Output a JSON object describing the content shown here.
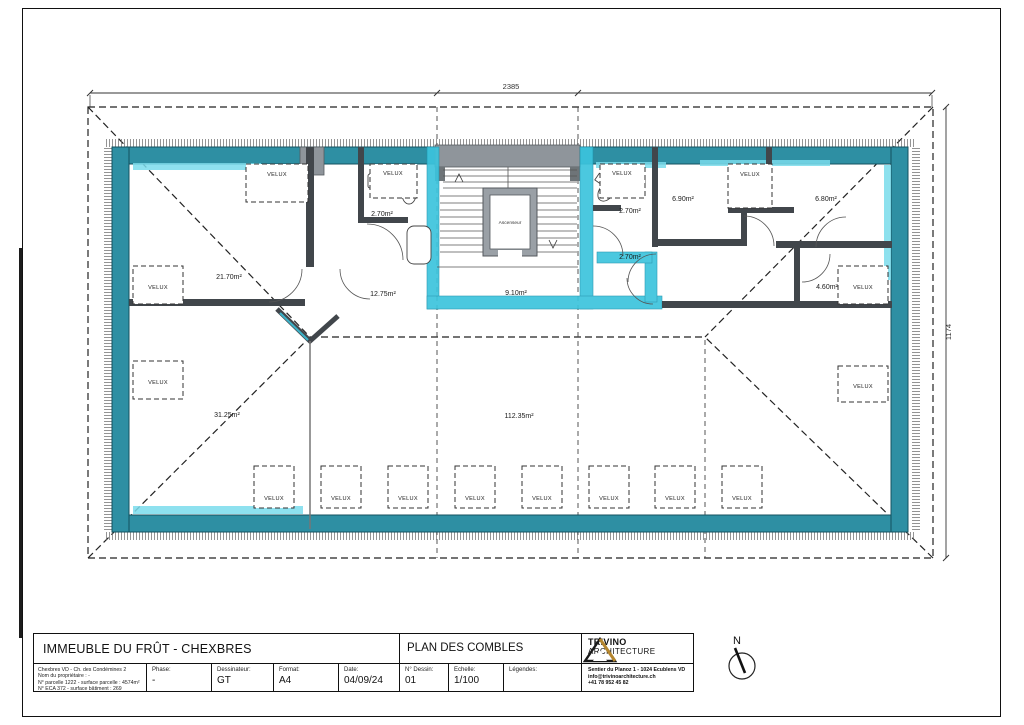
{
  "plan": {
    "velux_label": "VELUX",
    "elevator_label": "Ascenseur",
    "dim_top": "2385",
    "dim_right": "1174",
    "north_label": "N",
    "rooms": {
      "left_bedroom": "21.70m²",
      "left_bath": "2.70m²",
      "left_hall": "12.75m²",
      "corridor": "9.10m²",
      "right_bath": "2.70m²",
      "right_hall": "2.70m²",
      "right_room_a": "6.90m²",
      "right_room_b": "6.80m²",
      "right_room_c": "4.60m²",
      "lower_left_room": "31.25m²",
      "main_room": "112.35m²"
    },
    "colors": {
      "wall_teal": "#2e8fa3",
      "wall_cyan": "#3cc4dd",
      "stair_gray": "#8f959b"
    }
  },
  "titleblock": {
    "project_title": "IMMEUBLE DU FRÛT - CHEXBRES",
    "drawing_title": "PLAN DES COMBLES",
    "info_line_1": "Chexbres VD - Ch. des Condémines 2",
    "info_line_2": "Nom du propriétaire : -",
    "info_line_3": "N° parcelle 1222 - surface parcelle : 4574m²",
    "info_line_4": "N° ECA 372 - surface bâtiment : 269",
    "phase_label": "Phase:",
    "phase_value": "-",
    "drafter_label": "Dessinateur:",
    "drafter_value": "GT",
    "format_label": "Format:",
    "format_value": "A4",
    "date_label": "Date:",
    "date_value": "04/09/24",
    "number_label": "N° Dessin:",
    "number_value": "01",
    "scale_label": "Echelle:",
    "scale_value": "1/100",
    "legend_label": "Légendes:",
    "firm_name": "TRIVINO",
    "firm_subname": "ARCHITECTURE",
    "firm_address": "Sentier du Planoz 1 - 1024 Ecublens VD",
    "firm_email": "info@trivinoarchitecture.ch",
    "firm_phone": "+41 78 952 45 82"
  }
}
